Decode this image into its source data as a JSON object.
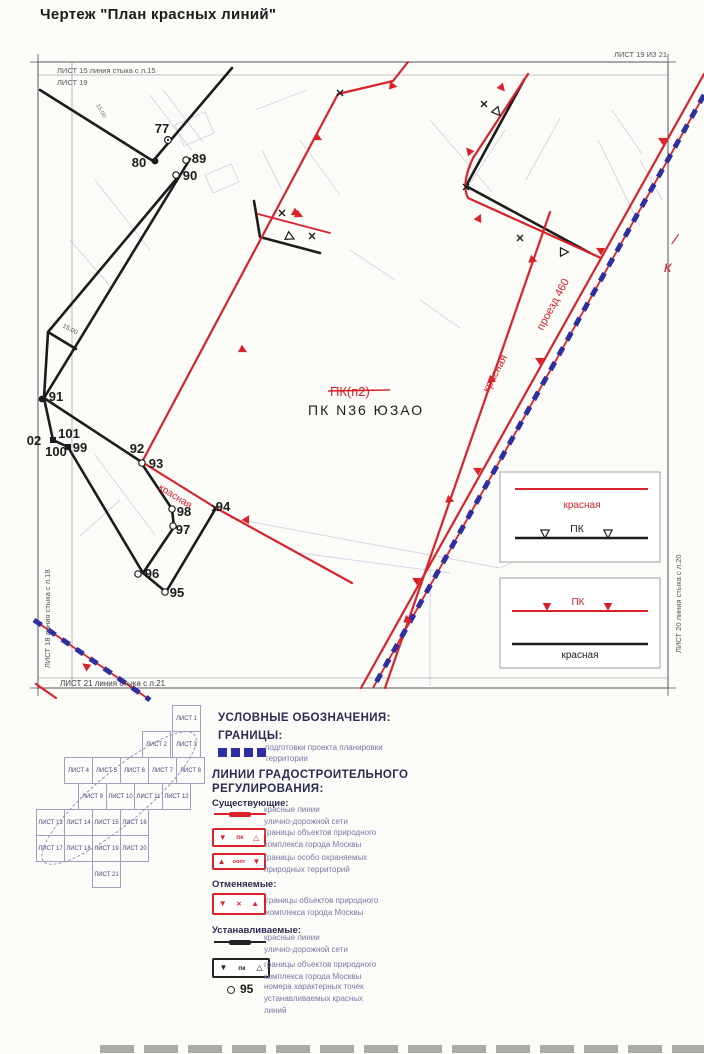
{
  "page": {
    "title": "Чертеж \"План красных линий\"",
    "sheet_ref": "ЛИСТ 19 ИЗ 21"
  },
  "map": {
    "edge_labels": {
      "top1": "ЛИСТ 15 линия стыка с л.15",
      "top2": "ЛИСТ 19",
      "left": "ЛИСТ 18 линия стыка с л.18",
      "right": "ЛИСТ 20 линия стыка с л.20",
      "bottom": "ЛИСТ 21 линия стыка с л.21"
    },
    "labels": {
      "pk_old": "ПК(п2)",
      "pk_new": "ПК N36 ЮЗАО",
      "street_krasnaya_low": "красная",
      "street_krasnaya_diag": "красная",
      "street_proezd": "проезд 460",
      "dim_left": "15.00",
      "dim_top": "15.00",
      "edge_letter_k": "к",
      "edge_slash": "/"
    },
    "points": {
      "p77": "77",
      "p80": "80",
      "p89": "89",
      "p90": "90",
      "p91": "91",
      "p92": "92",
      "p93": "93",
      "p94": "94",
      "p95": "95",
      "p96": "96",
      "p97": "97",
      "p98": "98",
      "p99": "99",
      "p100": "100",
      "p101": "101",
      "p102": "02"
    },
    "inset": {
      "box1_red": "красная",
      "box1_black": "ПК",
      "box2_red": "ПК",
      "box2_black": "красная"
    }
  },
  "sheet_index": {
    "cells": [
      "ЛИСТ 1",
      "ЛИСТ 2",
      "ЛИСТ 3",
      "ЛИСТ 4",
      "ЛИСТ 5",
      "ЛИСТ 6",
      "ЛИСТ 7",
      "ЛИСТ 8",
      "ЛИСТ 9",
      "ЛИСТ 10",
      "ЛИСТ 11",
      "ЛИСТ 12",
      "ЛИСТ 13",
      "ЛИСТ 14",
      "ЛИСТ 15",
      "ЛИСТ 16",
      "ЛИСТ 17",
      "ЛИСТ 18",
      "ЛИСТ 19",
      "ЛИСТ 20",
      "ЛИСТ 21"
    ]
  },
  "legend": {
    "title": "УСЛОВНЫЕ ОБОЗНАЧЕНИЯ:",
    "borders_title": "ГРАНИЦЫ:",
    "borders_item": {
      "line1": "подготовки проекта планировки",
      "line2": "территории"
    },
    "lines_title1": "ЛИНИИ ГРАДОСТРОИТЕЛЬНОГО",
    "lines_title2": "РЕГУЛИРОВАНИЯ:",
    "existing_title": "Существующие:",
    "existing_items": [
      {
        "line1": "красные линии",
        "line2": "улично-дорожной сети"
      },
      {
        "line1": "границы объектов природного",
        "line2": "комплекса города Москвы"
      },
      {
        "line1": "границы особо охраняемых",
        "line2": "природных территорий"
      }
    ],
    "cancelled_title": "Отменяемые:",
    "cancelled_items": [
      {
        "line1": "границы объектов природного",
        "line2": "комплекса города Москвы"
      }
    ],
    "established_title": "Устанавливаемые:",
    "established_items": [
      {
        "line1": "красные линии",
        "line2": "улично-дорожной сети"
      },
      {
        "line1": "границы объектов природного",
        "line2": "комплекса города Москвы"
      },
      {
        "line1": "номера характерных точек",
        "line2": "устанавливаемых красных",
        "line3": "линий"
      }
    ],
    "symbols": {
      "pk": "пк",
      "oopt": "оопт",
      "point_number": "95"
    },
    "icons": {
      "tri_down_filled": "▼",
      "tri_up_filled": "▲",
      "tri_up_outline": "△",
      "cross": "✕"
    }
  },
  "colors": {
    "red": "#d8232a",
    "blue": "#2d2fa0",
    "black": "#1c1c1c",
    "navy": "#2c2c54",
    "body_text": "#7678a8"
  }
}
